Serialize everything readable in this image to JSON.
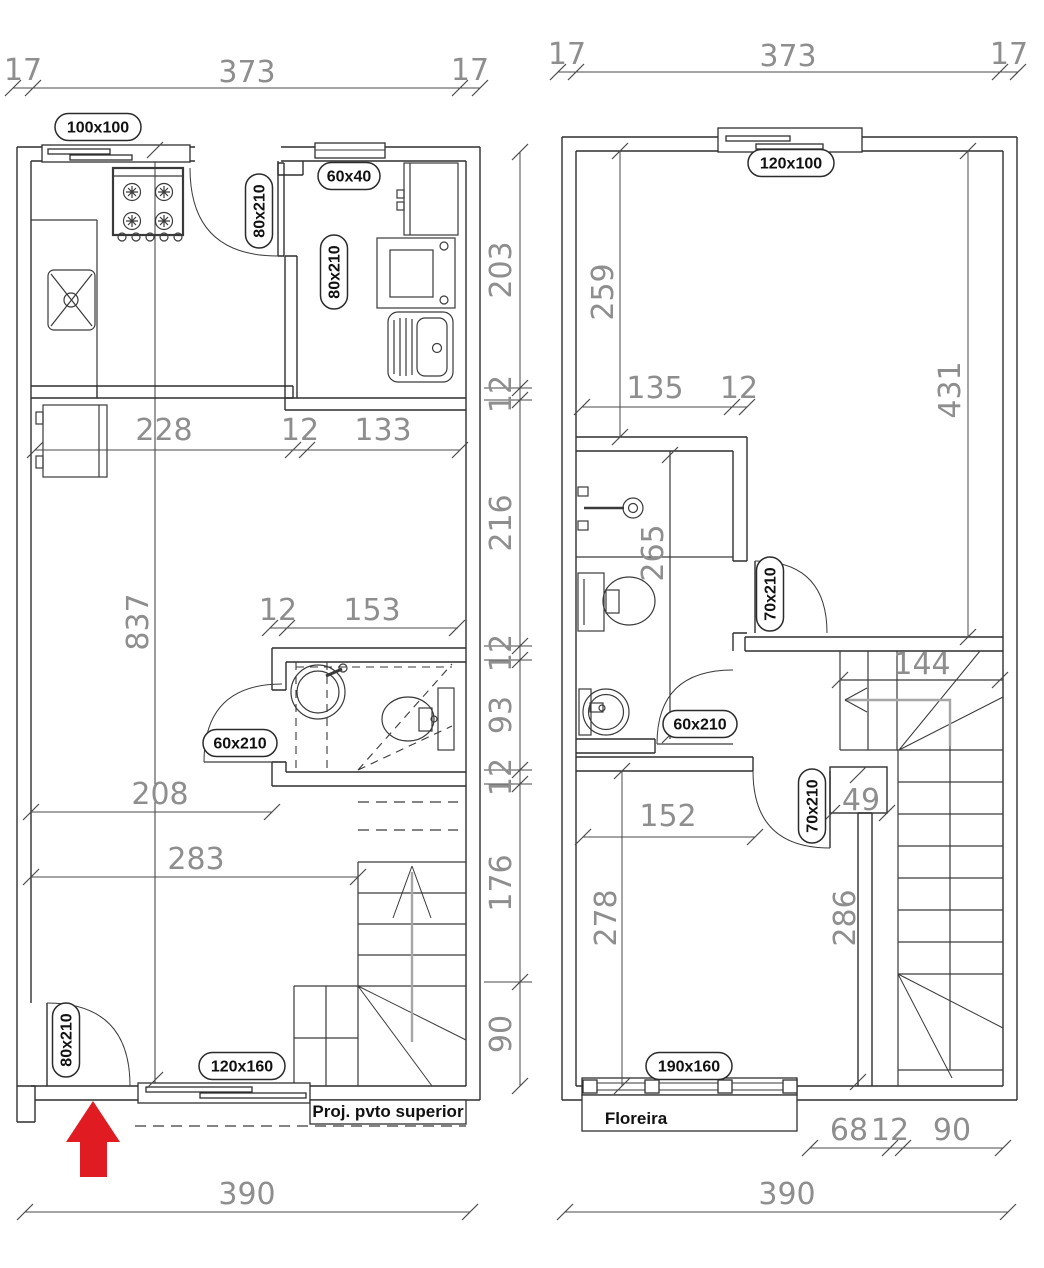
{
  "drawing_title": "Two-storey house floor plans",
  "colors": {
    "line": "#2f2f2f",
    "dim_text": "#8e8e8e",
    "label_text": "#111111",
    "entry_arrow": "#e01b22",
    "stair_arrow": "#a6a6a6"
  },
  "ground_floor": {
    "dim_top_left_wall": "17",
    "dim_top_width": "373",
    "dim_top_right_wall": "17",
    "dim_kitchen_width": "228",
    "dim_kitchen_wall": "12",
    "dim_service_width": "133",
    "dim_right_1": "203",
    "dim_right_2": "12",
    "dim_right_3": "216",
    "dim_right_4": "12",
    "dim_right_5": "93",
    "dim_right_6": "12",
    "dim_right_7": "176",
    "dim_right_8": "90",
    "dim_interior_height": "837",
    "dim_bath_wall": "12",
    "dim_bath_width": "153",
    "dim_living_width_1": "208",
    "dim_living_width_2": "283",
    "dim_bottom_width": "390",
    "label_window_kitchen": "100x100",
    "label_window_service": "60x40",
    "label_door_kitchen": "80x210",
    "label_door_service": "80x210",
    "label_door_bath": "60x210",
    "label_door_entry": "80x210",
    "label_window_front": "120x160",
    "note_projection": "Proj. pvto superior"
  },
  "upper_floor": {
    "dim_top_left_wall": "17",
    "dim_top_width": "373",
    "dim_top_right_wall": "17",
    "dim_bedroom1_depth": "259",
    "dim_bath_width": "135",
    "dim_bath_wall": "12",
    "dim_right_height": "431",
    "dim_bath_depth": "265",
    "dim_stair_width": "144",
    "dim_closet_width": "49",
    "dim_bedroom2_width": "152",
    "dim_bedroom2_depth": "278",
    "dim_bedroom2_right": "286",
    "dim_bottom_1": "68",
    "dim_bottom_2": "12",
    "dim_bottom_3": "90",
    "dim_bottom_width": "390",
    "label_window_bedroom1": "120x100",
    "label_door_bath_upper": "70x210",
    "label_door_bath": "60x210",
    "label_door_bedroom2": "70x210",
    "label_window_bedroom2": "190x160",
    "note_planter": "Floreira"
  }
}
